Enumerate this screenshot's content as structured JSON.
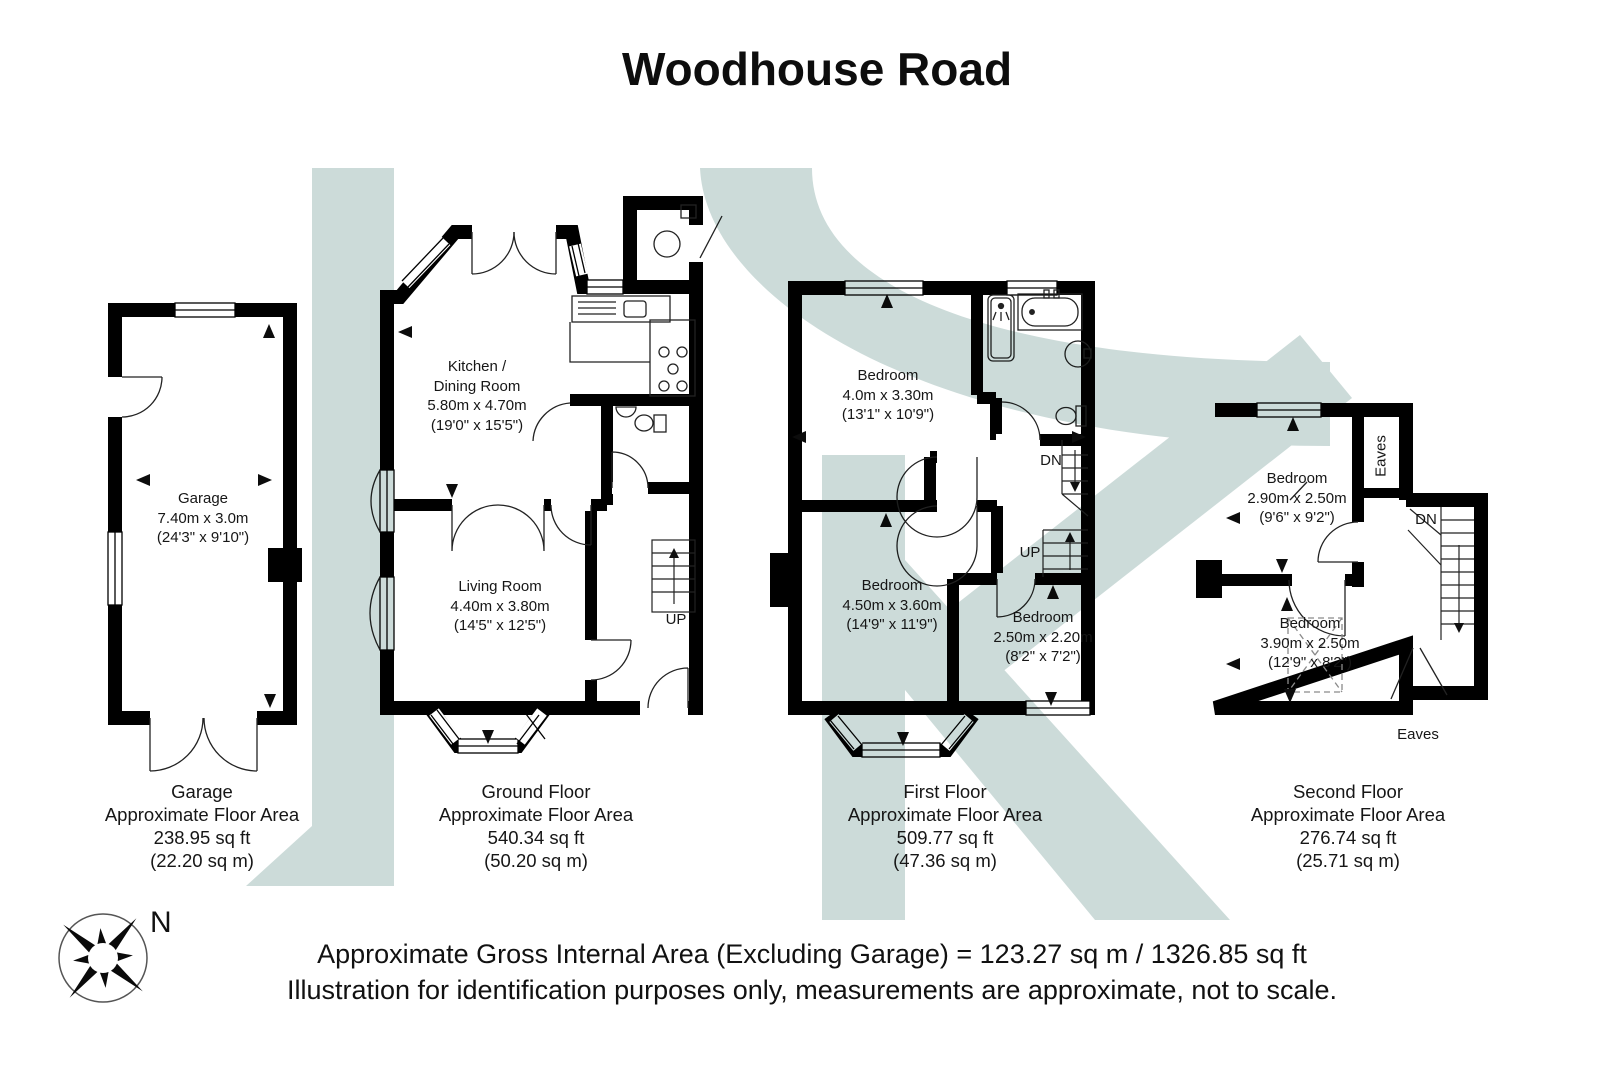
{
  "title": "Woodhouse Road",
  "compass": {
    "north_label": "N"
  },
  "footer": {
    "line1": "Approximate Gross Internal Area (Excluding Garage) = 123.27 sq m / 1326.85 sq ft",
    "line2": "Illustration for identification purposes only, measurements are approximate, not to scale."
  },
  "colors": {
    "wall": "#000000",
    "watermark": "#ccdbd9"
  },
  "plans": {
    "garage": {
      "rooms": [
        {
          "lines": [
            "Garage",
            "7.40m x 3.0m",
            "(24'3\" x 9'10\")"
          ]
        }
      ],
      "caption": [
        "Garage",
        "Approximate Floor Area",
        "238.95 sq ft",
        "(22.20 sq m)"
      ]
    },
    "ground_floor": {
      "rooms": [
        {
          "lines": [
            "Kitchen /",
            "Dining Room",
            "5.80m x 4.70m",
            "(19'0\" x 15'5\")"
          ]
        },
        {
          "lines": [
            "Living Room",
            "4.40m x 3.80m",
            "(14'5\" x 12'5\")"
          ]
        }
      ],
      "stair_labels": [
        "UP"
      ],
      "caption": [
        "Ground Floor",
        "Approximate Floor Area",
        "540.34 sq ft",
        "(50.20 sq m)"
      ]
    },
    "first_floor": {
      "rooms": [
        {
          "lines": [
            "Bedroom",
            "4.0m x 3.30m",
            "(13'1\" x 10'9\")"
          ]
        },
        {
          "lines": [
            "Bedroom",
            "4.50m x 3.60m",
            "(14'9\" x 11'9\")"
          ]
        },
        {
          "lines": [
            "Bedroom",
            "2.50m x 2.20m",
            "(8'2\" x 7'2\")"
          ]
        }
      ],
      "stair_labels": [
        "DN",
        "UP"
      ],
      "caption": [
        "First Floor",
        "Approximate Floor Area",
        "509.77 sq ft",
        "(47.36 sq m)"
      ]
    },
    "second_floor": {
      "rooms": [
        {
          "lines": [
            "Bedroom",
            "2.90m x 2.50m",
            "(9'6\" x 9'2\")"
          ]
        },
        {
          "lines": [
            "Bedroom",
            "3.90m x 2.50m",
            "(12'9\" x 8'2\")"
          ]
        }
      ],
      "stair_labels": [
        "DN"
      ],
      "eaves_labels": [
        "Eaves",
        "Eaves"
      ],
      "caption": [
        "Second Floor",
        "Approximate Floor Area",
        "276.74 sq ft",
        "(25.71 sq m)"
      ]
    }
  }
}
